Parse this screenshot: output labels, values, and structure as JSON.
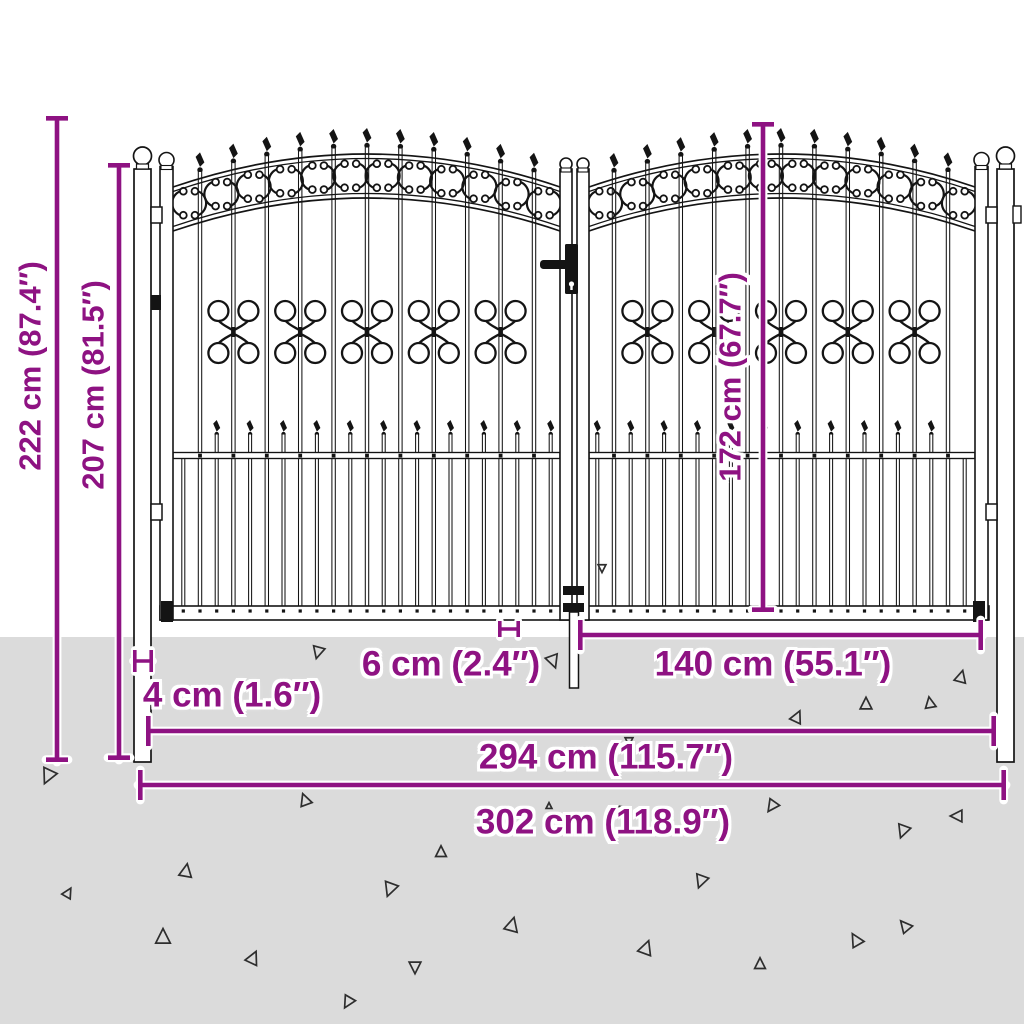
{
  "dims": {
    "height_total": "222 cm (87.4″)",
    "height_post": "207 cm (81.5″)",
    "height_leaf": "172 cm (67.7″)",
    "width_post": "4 cm (1.6″)",
    "width_gap": "6 cm (2.4″)",
    "width_leaf": "140 cm (55.1″)",
    "width_inner": "294 cm (115.7″)",
    "width_total": "302 cm (118.9″)"
  },
  "colors": {
    "dimension_purple": "#8e1282",
    "ground_gray": "#dbdbdb",
    "line_black": "#141414",
    "background_white": "#ffffff"
  }
}
